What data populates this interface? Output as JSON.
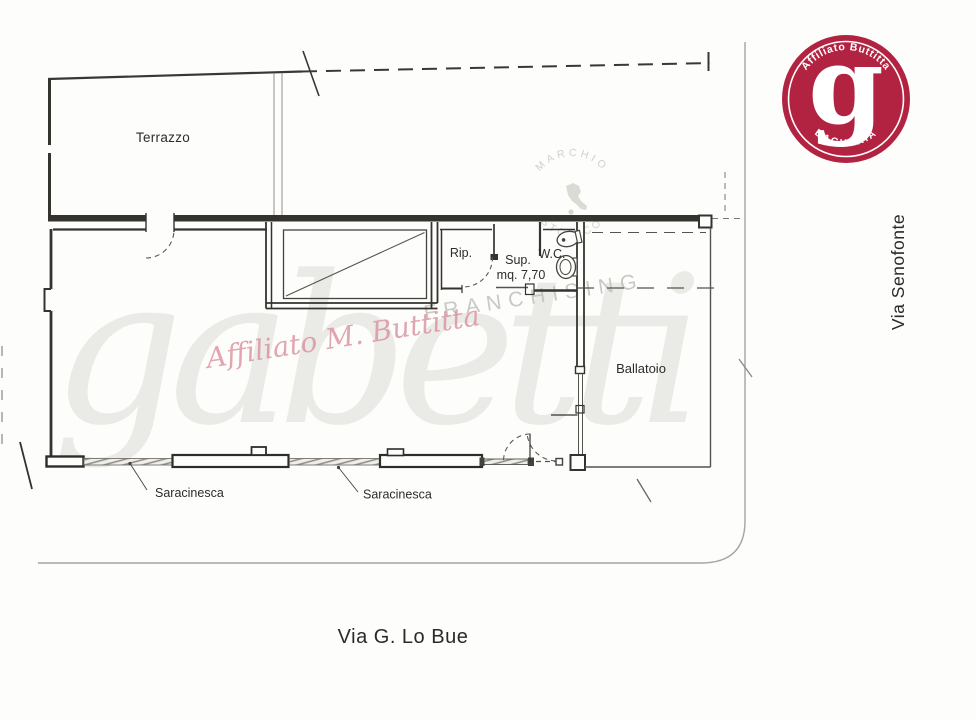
{
  "floor_plan": {
    "rooms": {
      "terrazzo": "Terrazzo",
      "rip": "Rip.",
      "sup_line1": "Sup.",
      "sup_line2": "mq. 7,70",
      "wc": "W.C.",
      "ballatoio": "Ballatoio"
    },
    "annotations": {
      "saracinesca_left": "Saracinesca",
      "saracinesca_right": "Saracinesca"
    },
    "streets": {
      "bottom": "Via G. Lo Bue",
      "right": "Via Senofonte"
    }
  },
  "logo": {
    "arc_top": "Affiliato Buttitta",
    "monogram": "g",
    "arc_bottom": "BAGHERIA",
    "background_color": "#b22342"
  },
  "watermarks": {
    "brand_script": "gabetti",
    "franchising": "FRANCHISING",
    "seal_top": "MARCHIO",
    "seal_bottom": "STORICO",
    "affiliate_script": "Affiliato M. Buttitta",
    "pink_color": "#dc93a0"
  },
  "colors": {
    "ink": "#35332e",
    "curb": "#a6a49e",
    "background": "#fcfcfa"
  }
}
